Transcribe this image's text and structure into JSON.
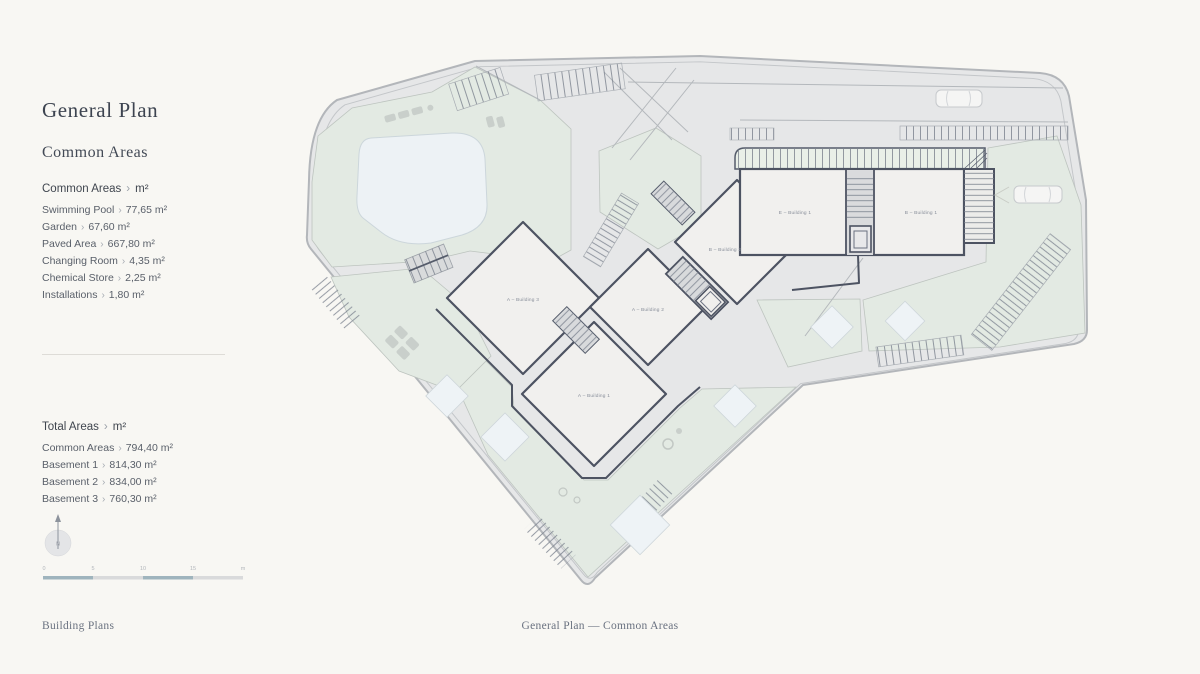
{
  "sidebar": {
    "title": "General Plan",
    "subtitle": "Common Areas",
    "sep": "›",
    "sections": [
      {
        "heading": "Common Areas",
        "unit": "m²",
        "items": [
          {
            "label": "Swimming Pool",
            "value": "77,65 m²"
          },
          {
            "label": "Garden",
            "value": "67,60 m²"
          },
          {
            "label": "Paved Area",
            "value": "667,80 m²"
          },
          {
            "label": "Changing Room",
            "value": "4,35 m²"
          },
          {
            "label": "Chemical Store",
            "value": "2,25 m²"
          },
          {
            "label": "Installations",
            "value": "1,80 m²"
          }
        ]
      },
      {
        "heading": "Total Areas",
        "unit": "m²",
        "items": [
          {
            "label": "Common Areas",
            "value": "794,40 m²"
          },
          {
            "label": "Basement 1",
            "value": "814,30 m²"
          },
          {
            "label": "Basement 2",
            "value": "834,00 m²"
          },
          {
            "label": "Basement 3",
            "value": "760,30 m²"
          }
        ]
      }
    ]
  },
  "compass": {
    "direction": "N"
  },
  "scale_bar": {
    "ticks": [
      "0",
      "5",
      "10",
      "15",
      "m"
    ]
  },
  "plan": {
    "buildings": [
      {
        "label": "E – Building 1"
      },
      {
        "label": "B – Building 1"
      },
      {
        "label": "B – Building 2"
      },
      {
        "label": "A – Building 3"
      },
      {
        "label": "A – Building 2"
      },
      {
        "label": "A – Building 1"
      }
    ]
  },
  "footer": {
    "building_plans": "Building Plans",
    "breadcrumb": "General Plan — Common Areas"
  },
  "colors": {
    "background": "#f8f7f3",
    "paved": "#e6e7e8",
    "garden_green": "#e3eae3",
    "pool_blue": "#edf2f5",
    "building_outline": "#4d5362",
    "scale_blue": "#9fb4bd"
  }
}
